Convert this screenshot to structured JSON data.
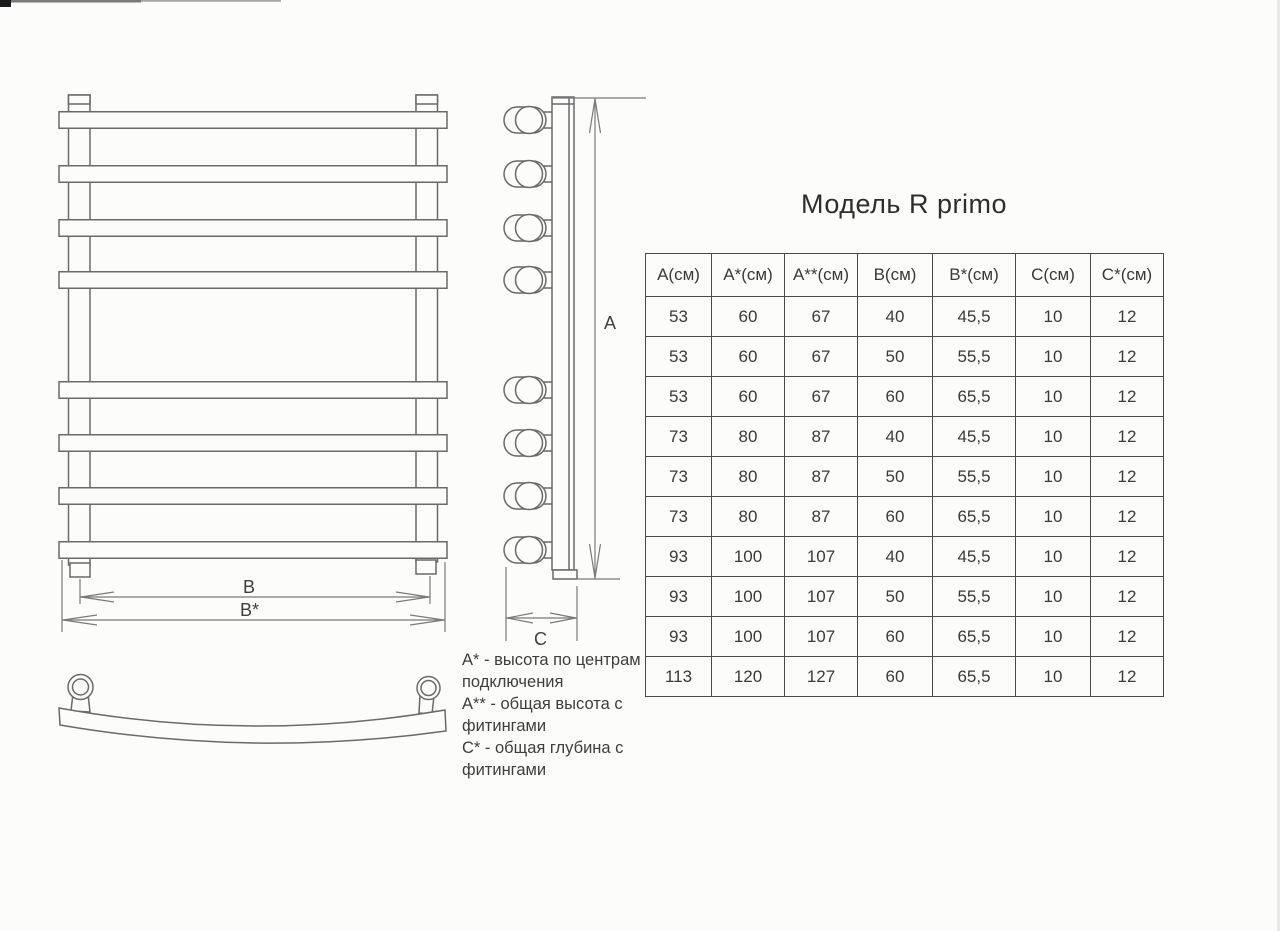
{
  "page": {
    "title": "Модель R primo"
  },
  "drawing": {
    "dim_labels": {
      "a": "А",
      "b": "В",
      "b_star": "В*",
      "c": "С"
    }
  },
  "legend": {
    "items": [
      "А* - высота по центрам\nподключения",
      "А** - общая высота с\nфитингами",
      "С* - общая глубина с\nфитингами"
    ]
  },
  "table": {
    "headers": [
      "А(см)",
      "А*(см)",
      "А**(см)",
      "В(см)",
      "В*(см)",
      "С(см)",
      "С*(см)"
    ],
    "rows": [
      [
        "53",
        "60",
        "67",
        "40",
        "45,5",
        "10",
        "12"
      ],
      [
        "53",
        "60",
        "67",
        "50",
        "55,5",
        "10",
        "12"
      ],
      [
        "53",
        "60",
        "67",
        "60",
        "65,5",
        "10",
        "12"
      ],
      [
        "73",
        "80",
        "87",
        "40",
        "45,5",
        "10",
        "12"
      ],
      [
        "73",
        "80",
        "87",
        "50",
        "55,5",
        "10",
        "12"
      ],
      [
        "73",
        "80",
        "87",
        "60",
        "65,5",
        "10",
        "12"
      ],
      [
        "93",
        "100",
        "107",
        "40",
        "45,5",
        "10",
        "12"
      ],
      [
        "93",
        "100",
        "107",
        "50",
        "55,5",
        "10",
        "12"
      ],
      [
        "93",
        "100",
        "107",
        "60",
        "65,5",
        "10",
        "12"
      ],
      [
        "113",
        "120",
        "127",
        "60",
        "65,5",
        "10",
        "12"
      ]
    ]
  }
}
